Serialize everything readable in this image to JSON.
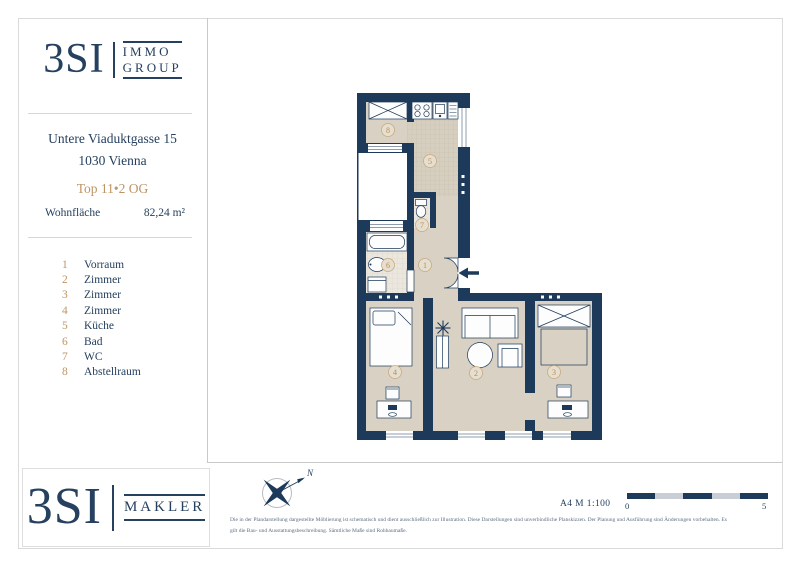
{
  "colors": {
    "navy": "#26405f",
    "wall_navy": "#1d3a5a",
    "tan_accent": "#bf9464",
    "floor_beige": "#d8d1c4",
    "scale_light": "#c9ced6"
  },
  "sidebar": {
    "logo": {
      "brand": "3SI",
      "line1": "IMMO",
      "line2": "GROUP"
    },
    "address_line1": "Untere Viaduktgasse 15",
    "address_line2": "1030 Vienna",
    "unit": "Top 11•2 OG",
    "area_label": "Wohnfläche",
    "area_value": "82,24 m²",
    "rooms": [
      {
        "num": "1",
        "name": "Vorraum"
      },
      {
        "num": "2",
        "name": "Zimmer"
      },
      {
        "num": "3",
        "name": "Zimmer"
      },
      {
        "num": "4",
        "name": "Zimmer"
      },
      {
        "num": "5",
        "name": "Küche"
      },
      {
        "num": "6",
        "name": "Bad"
      },
      {
        "num": "7",
        "name": "WC"
      },
      {
        "num": "8",
        "name": "Abstellraum"
      }
    ]
  },
  "footer": {
    "logo": {
      "brand": "3SI",
      "suffix": "MAKLER"
    },
    "compass_label": "N",
    "format_scale": "A4 M 1:100",
    "scalebar_start": "0",
    "scalebar_end": "5",
    "disclaimer1": "Die in der Plandarstellung dargestellte Möblierung ist schematisch und dient ausschließlich zur Illustration. Diese Darstellungen sind unverbindliche Planskizzen. Der Planung und Ausführung sind Änderungen vorbehalten. Es",
    "disclaimer2": "gilt die Bau- und Ausstattungsbeschreibung. Sämtliche Maße sind Rohbaumaße."
  }
}
